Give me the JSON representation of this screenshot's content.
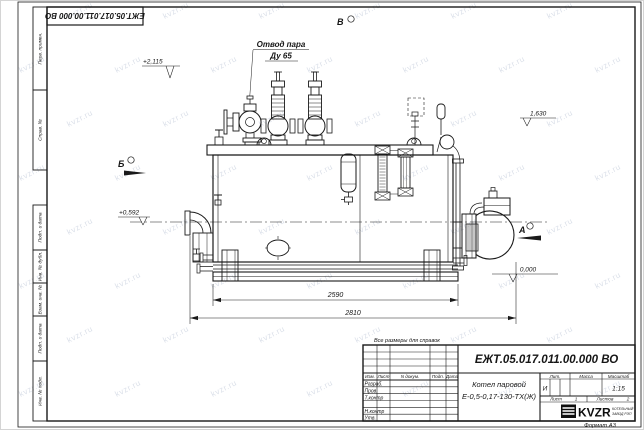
{
  "page": {
    "watermark_text": "kvzr.ru",
    "format_note": "Формат А3",
    "reference_note": "Все размеры для справок"
  },
  "corner_stamp": {
    "doc_number": "ЕЖТ.05.017.011.00.000  ВО"
  },
  "margin_labels": [
    "Перв. примен.",
    "Справ. №",
    "Подп. и дата",
    "Инв. № дубл.",
    "Взам. инв. №",
    "Подп. и дата",
    "Инв. № подл."
  ],
  "drawing": {
    "callouts": {
      "steam_outlet_line1": "Отвод пара",
      "steam_outlet_line2": "Ду 65"
    },
    "views": {
      "top": "В",
      "left": "Б",
      "right": "А"
    },
    "elevations": {
      "valve_top": "+2,115",
      "shell_top": "1,630",
      "axis": "+0,592",
      "ground": "0,000"
    },
    "dimensions": {
      "shell_length": "2590",
      "overall_length": "2810"
    }
  },
  "title_block": {
    "doc_number": "ЕЖТ.05.017.011.00.000  ВО",
    "product_line1": "Котел паровой",
    "product_line2": "Е-0,5-0,17-130-ТХ(Ж)",
    "header_columns": [
      "Изм.",
      "Лист",
      "N докум.",
      "Подп.",
      "Дата"
    ],
    "signature_rows": [
      "Разраб.",
      "Пров.",
      "Т.контр",
      "Н.контр",
      "Утв."
    ],
    "litera_label": "Лит.",
    "litera_value": "И",
    "mass_label": "Масса",
    "scale_label": "Масштаб",
    "scale_value": "1:15",
    "sheet_label": "Лист",
    "sheet_value": "1",
    "sheets_label": "Листов",
    "sheets_value": "2",
    "company_name": "KVZR",
    "company_line1": "КОТЕЛЬНЫЙ",
    "company_line2": "ЗАВОД РЭП"
  }
}
